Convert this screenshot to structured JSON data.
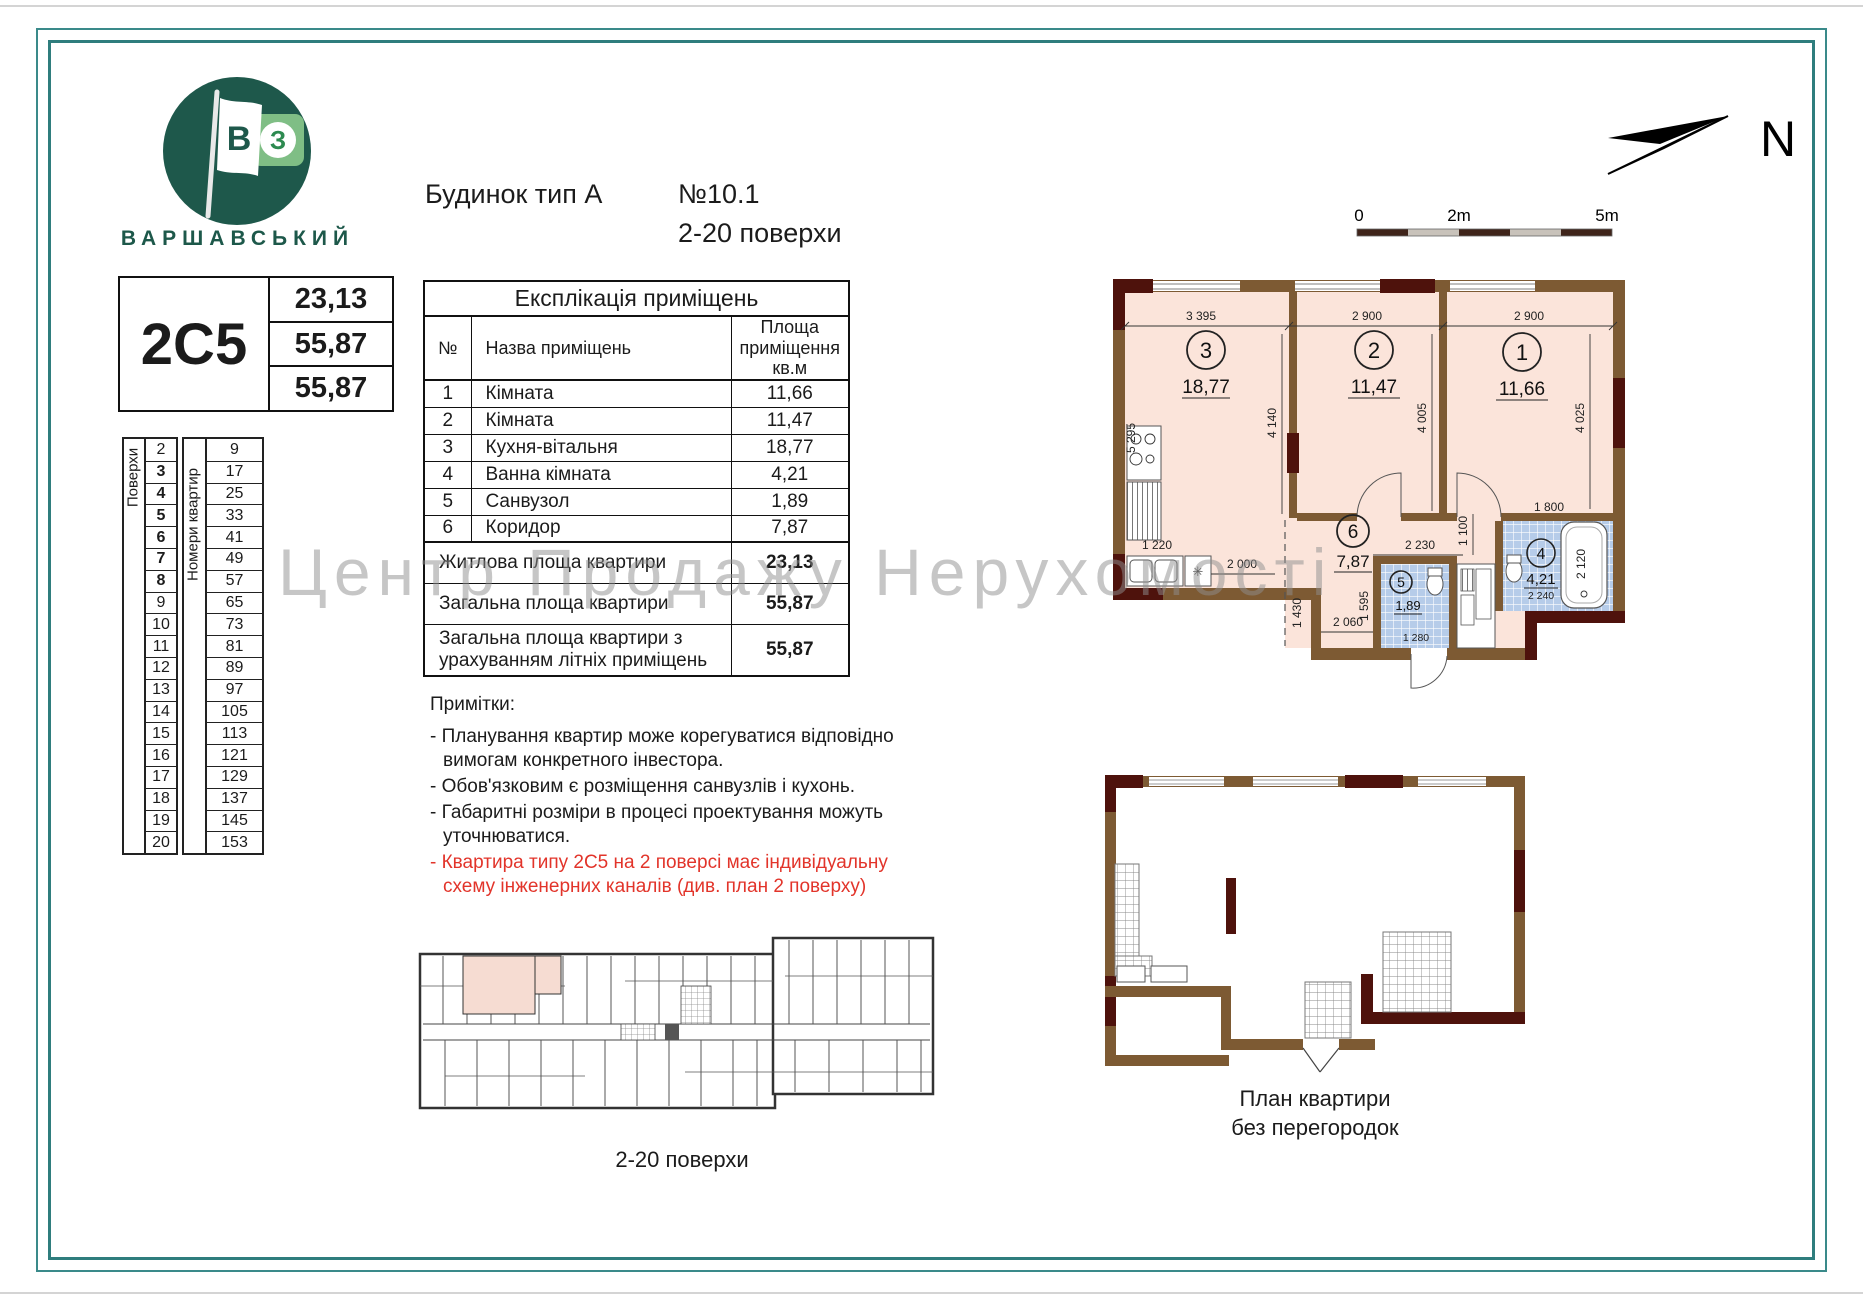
{
  "colors": {
    "frame_teal": "#2f7d7d",
    "brand_green": "#1d584a",
    "logo_light_green": "#7fbe85",
    "note_red": "#e2342a",
    "plan_pink": "#fbe4da",
    "tile_blue": "#b6cce9",
    "wall_brown": "#7d5a33",
    "wall_maroon": "#4e120c",
    "watermark_gray": "#8f8f8f"
  },
  "header": {
    "brand": "ВАРШАВСЬКИЙ",
    "logo_flag_letter": "В",
    "logo_square_letter": "З",
    "building_type": "Будинок тип А",
    "number": "№10.1",
    "floors_range": "2-20 поверхи",
    "north_label": "N",
    "scale": {
      "start": "0",
      "mid": "2m",
      "end": "5m"
    }
  },
  "watermark": "Центр Продажу Нерухомості",
  "apartment_card": {
    "code": "2С5",
    "values": [
      "23,13",
      "55,87",
      "55,87"
    ]
  },
  "floors_table": {
    "floors_label": "Поверхи",
    "numbers_label": "Номери квартир",
    "rows": [
      {
        "floor": "2",
        "apt": "9",
        "bold": false
      },
      {
        "floor": "3",
        "apt": "17",
        "bold": true
      },
      {
        "floor": "4",
        "apt": "25",
        "bold": true
      },
      {
        "floor": "5",
        "apt": "33",
        "bold": true
      },
      {
        "floor": "6",
        "apt": "41",
        "bold": true
      },
      {
        "floor": "7",
        "apt": "49",
        "bold": true
      },
      {
        "floor": "8",
        "apt": "57",
        "bold": true
      },
      {
        "floor": "9",
        "apt": "65",
        "bold": false
      },
      {
        "floor": "10",
        "apt": "73",
        "bold": false
      },
      {
        "floor": "11",
        "apt": "81",
        "bold": false
      },
      {
        "floor": "12",
        "apt": "89",
        "bold": false
      },
      {
        "floor": "13",
        "apt": "97",
        "bold": false
      },
      {
        "floor": "14",
        "apt": "105",
        "bold": false
      },
      {
        "floor": "15",
        "apt": "113",
        "bold": false
      },
      {
        "floor": "16",
        "apt": "121",
        "bold": false
      },
      {
        "floor": "17",
        "apt": "129",
        "bold": false
      },
      {
        "floor": "18",
        "apt": "137",
        "bold": false
      },
      {
        "floor": "19",
        "apt": "145",
        "bold": false
      },
      {
        "floor": "20",
        "apt": "153",
        "bold": false
      }
    ]
  },
  "explication": {
    "title": "Експлікація приміщень",
    "col_no": "№",
    "col_name": "Назва приміщень",
    "col_area": "Площа приміщення кв.м",
    "rooms": [
      {
        "no": "1",
        "name": "Кімната",
        "area": "11,66"
      },
      {
        "no": "2",
        "name": "Кімната",
        "area": "11,47"
      },
      {
        "no": "3",
        "name": "Кухня-вітальня",
        "area": "18,77"
      },
      {
        "no": "4",
        "name": "Ванна кімната",
        "area": "4,21"
      },
      {
        "no": "5",
        "name": "Санвузол",
        "area": "1,89"
      },
      {
        "no": "6",
        "name": "Коридор",
        "area": "7,87"
      }
    ],
    "totals": [
      {
        "name": "Житлова площа квартири",
        "area": "23,13"
      },
      {
        "name": "Загальна площа квартири",
        "area": "55,87"
      },
      {
        "name": "Загальна площа квартири з урахуванням літніх приміщень",
        "area": "55,87"
      }
    ]
  },
  "notes": {
    "title": "Примітки:",
    "items": [
      {
        "text": "Планування квартир може корегуватися відповідно вимогам конкретного інвестора.",
        "red": false
      },
      {
        "text": "Обов'язковим є розміщення санвузлів і кухонь.",
        "red": false
      },
      {
        "text": "Габаритні розміри в процесі проектування можуть уточнюватися.",
        "red": false
      },
      {
        "text": "Квартира типу 2С5 на 2 поверсі має індивідуальну схему інженерних каналів  (див. план 2 поверху)",
        "red": true
      }
    ]
  },
  "main_plan": {
    "rooms": [
      {
        "num": "3",
        "area": "18,77"
      },
      {
        "num": "2",
        "area": "11,47"
      },
      {
        "num": "1",
        "area": "11,66"
      },
      {
        "num": "6",
        "area": "7,87"
      },
      {
        "num": "5",
        "area": "1,89"
      },
      {
        "num": "4",
        "area": "4,21"
      }
    ],
    "dims": {
      "top": [
        "3 395",
        "2 900",
        "2 900"
      ],
      "left": "5 295",
      "room3_h": "4 140",
      "room2_h": "4 005",
      "room1_h": "4 025",
      "kitchen": "1 220",
      "kitchen_w": "2 000",
      "hall1": "1 430",
      "hall2": "2 060",
      "hall3": "1 595",
      "corr": "2 230",
      "corr_h": "1 100",
      "bath_w": "1 800",
      "bath_h": "2 120",
      "bath_d": "2 240",
      "wc_w": "1 280"
    }
  },
  "overview_plan": {
    "label": "2-20 поверхи"
  },
  "open_plan": {
    "label_line1": "План квартири",
    "label_line2": "без перегородок"
  }
}
